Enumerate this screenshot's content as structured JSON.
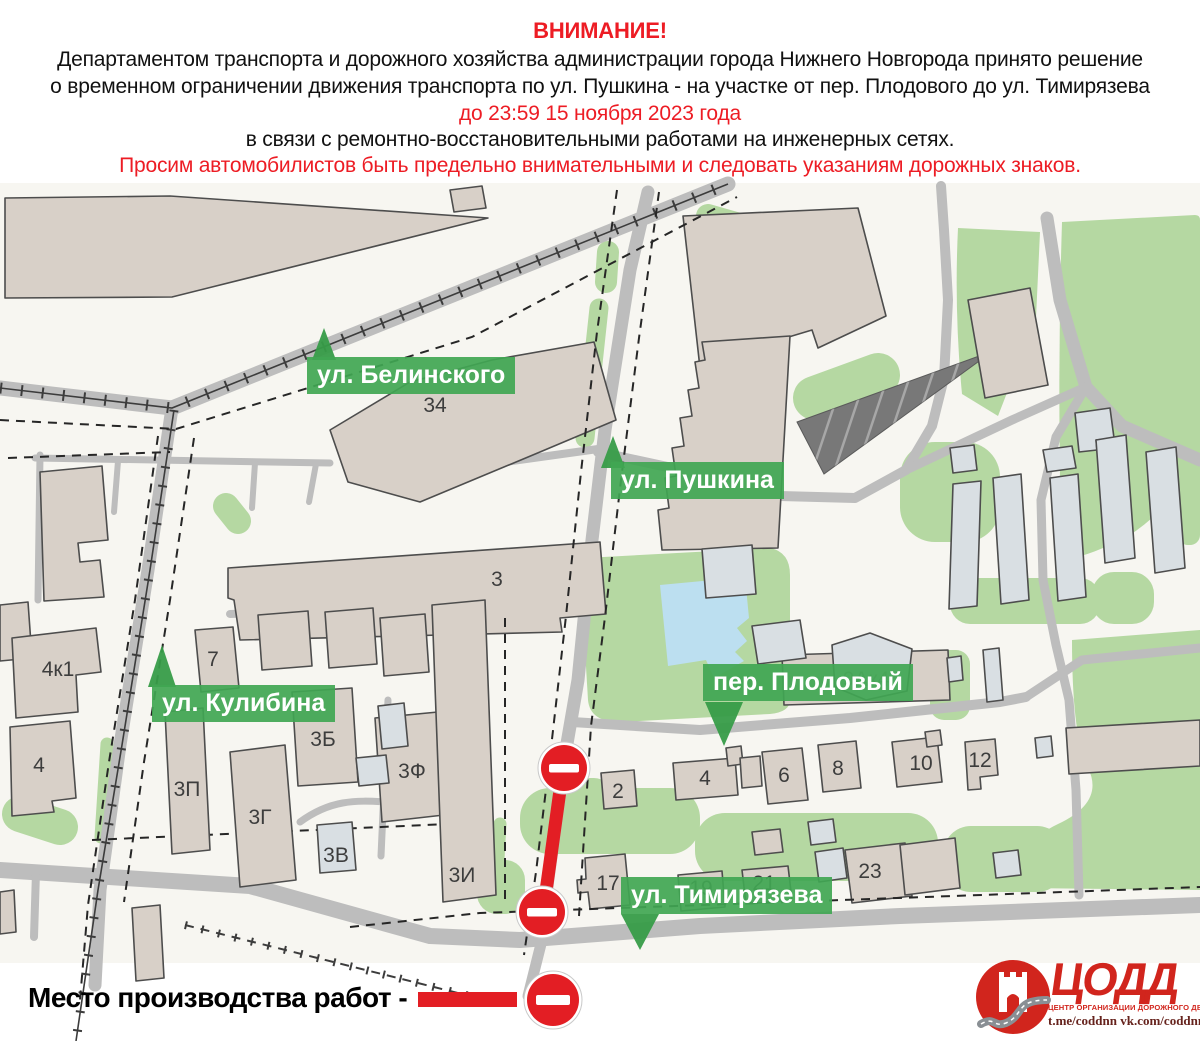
{
  "header": {
    "title": "ВНИМАНИЕ!",
    "line1": "Департаментом транспорта и дорожного хозяйства администрации города Нижнего Новгорода принято решение",
    "line2": "о временном ограничении движения транспорта по ул. Пушкина - на участке от пер. Плодового до ул. Тимирязева",
    "line3": "до 23:59 15 ноября 2023 года",
    "line4": "в связи с ремонтно-восстановительными работами на инженерных сетях.",
    "line5": "Просим автомобилистов быть предельно внимательными и следовать указаниям дорожных знаков."
  },
  "map": {
    "street_labels": [
      {
        "name": "ул. Белинского"
      },
      {
        "name": "ул. Пушкина"
      },
      {
        "name": "ул. Кулибина"
      },
      {
        "name": "пер. Плодовый"
      },
      {
        "name": "ул. Тимирязева"
      }
    ],
    "building_labels": [
      "34",
      "3",
      "4к1",
      "7",
      "4",
      "3П",
      "3Б",
      "3Г",
      "3В",
      "3Ф",
      "3И",
      "9Ак4",
      "2",
      "4",
      "6",
      "8",
      "10",
      "12",
      "17",
      "19",
      "21",
      "23"
    ]
  },
  "legend": {
    "text": "Место производства работ -"
  },
  "logo": {
    "name": "ЦОДД",
    "subtitle": "ЦЕНТР ОРГАНИЗАЦИИ ДОРОЖНОГО ДВИЖЕНИЯ",
    "links": "t.me/coddnn vk.com/coddnn52"
  },
  "colors": {
    "accent_red": "#e31e24",
    "header_red": "#ed1c24",
    "label_green": "#40a652",
    "green_area": "#b5d8a2",
    "pond_blue": "#bcdff0",
    "road_gray": "#bdbdbd",
    "building_beige": "#d8d0c8",
    "building_grayblue": "#d9dfe3"
  }
}
